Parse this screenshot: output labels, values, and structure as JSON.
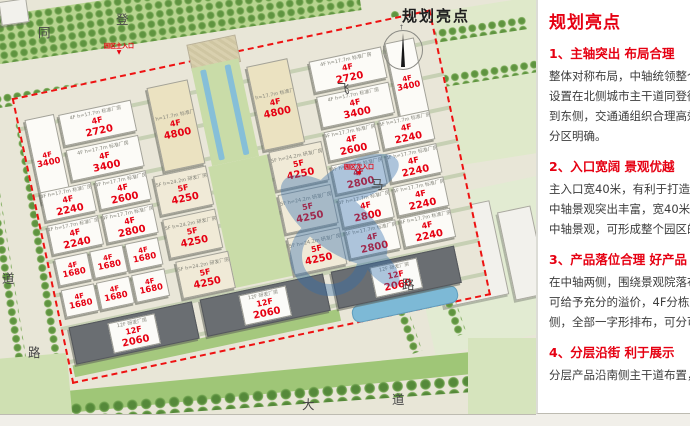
{
  "panel": {
    "title": "规划亮点",
    "accent_color": "#e60012",
    "sections": [
      {
        "heading": "1、主轴突出 布局合理",
        "lines": [
          "整体对称布局，中轴统领整个",
          "设置在北侧城市主干道同登街",
          "到东侧，交通通组织合理高效",
          "分区明确。"
        ]
      },
      {
        "heading": "2、入口宽阔 景观优越",
        "lines": [
          "主入口宽40米，有利于打造园",
          "中轴景观突出丰富，宽40米长",
          "中轴景观，可形成整个园区的"
        ]
      },
      {
        "heading": "3、产品落位合理 好产品",
        "lines": [
          "在中轴两侧，围绕景观院落布",
          "可给予充分的溢价，4F分栋产",
          "侧，全部一字形排布，可分可"
        ]
      },
      {
        "heading": "4、分层沿街 利于展示",
        "lines": [
          "分层产品沿南侧主干道布置，"
        ]
      }
    ]
  },
  "map": {
    "title": "规划亮点",
    "boundary_color": "#ee1212",
    "label_color": "#e60012",
    "road_labels": [
      {
        "t": "同",
        "x": 38,
        "y": 22
      },
      {
        "t": "登",
        "x": 116,
        "y": 9
      },
      {
        "t": "飞",
        "x": 337,
        "y": 78
      },
      {
        "t": "马",
        "x": 371,
        "y": 174
      },
      {
        "t": "路",
        "x": 402,
        "y": 274
      },
      {
        "t": "道",
        "x": 2,
        "y": 268
      },
      {
        "t": "路",
        "x": 28,
        "y": 342
      },
      {
        "t": "大",
        "x": 302,
        "y": 394
      },
      {
        "t": "道",
        "x": 392,
        "y": 389
      }
    ],
    "entrances": [
      {
        "label": "园区主入口",
        "x": 104,
        "y": 41,
        "arrow": true
      },
      {
        "label": "园区次入口",
        "x": 344,
        "y": 162,
        "arrow": true
      }
    ],
    "buildings": [
      {
        "x": 66,
        "y": 50,
        "w": 28,
        "h": 84,
        "f": "4F",
        "a": "3400",
        "cap": "4F h=17.7m 标准厂房",
        "t": "std"
      },
      {
        "x": 100,
        "y": 52,
        "w": 72,
        "h": 30,
        "f": "4F",
        "a": "2720",
        "cap": "4F h=17.7m 标准厂房",
        "t": "std"
      },
      {
        "x": 100,
        "y": 88,
        "w": 72,
        "h": 30,
        "f": "4F",
        "a": "3400",
        "cap": "4F h=17.7m 标准厂房",
        "t": "std"
      },
      {
        "x": 66,
        "y": 124,
        "w": 50,
        "h": 28,
        "f": "4F",
        "a": "2240",
        "cap": "4F h=17.7m 标准厂房",
        "t": "std"
      },
      {
        "x": 122,
        "y": 124,
        "w": 50,
        "h": 28,
        "f": "4F",
        "a": "2600",
        "cap": "4F h=17.7m 标准厂房",
        "t": "std"
      },
      {
        "x": 66,
        "y": 158,
        "w": 50,
        "h": 28,
        "f": "4F",
        "a": "2240",
        "cap": "4F h=17.7m 标准厂房",
        "t": "std"
      },
      {
        "x": 122,
        "y": 158,
        "w": 50,
        "h": 28,
        "f": "4F",
        "a": "2800",
        "cap": "4F h=17.7m 标准厂房",
        "t": "std"
      },
      {
        "x": 66,
        "y": 192,
        "w": 32,
        "h": 26,
        "f": "4F",
        "a": "1680",
        "cap": "",
        "t": "std"
      },
      {
        "x": 102,
        "y": 192,
        "w": 32,
        "h": 26,
        "f": "4F",
        "a": "1680",
        "cap": "",
        "t": "std"
      },
      {
        "x": 138,
        "y": 192,
        "w": 32,
        "h": 26,
        "f": "4F",
        "a": "1680",
        "cap": "",
        "t": "std"
      },
      {
        "x": 66,
        "y": 224,
        "w": 32,
        "h": 26,
        "f": "4F",
        "a": "1680",
        "cap": "",
        "t": "std"
      },
      {
        "x": 102,
        "y": 224,
        "w": 32,
        "h": 26,
        "f": "4F",
        "a": "1680",
        "cap": "",
        "t": "std"
      },
      {
        "x": 138,
        "y": 224,
        "w": 32,
        "h": 26,
        "f": "4F",
        "a": "1680",
        "cap": "",
        "t": "std"
      },
      {
        "x": 192,
        "y": 44,
        "w": 40,
        "h": 84,
        "f": "4F",
        "a": "4800",
        "cap": "4F h=17.7m 标准厂房",
        "t": "tall"
      },
      {
        "x": 294,
        "y": 44,
        "w": 40,
        "h": 84,
        "f": "4F",
        "a": "4800",
        "cap": "4F h=17.7m 标准厂房",
        "t": "tall"
      },
      {
        "x": 180,
        "y": 132,
        "w": 52,
        "h": 38,
        "f": "5F",
        "a": "4250",
        "cap": "5F h=24.2m 研发厂房",
        "t": "rnd"
      },
      {
        "x": 298,
        "y": 132,
        "w": 52,
        "h": 38,
        "f": "5F",
        "a": "4250",
        "cap": "5F h=24.2m 研发厂房",
        "t": "rnd"
      },
      {
        "x": 180,
        "y": 176,
        "w": 52,
        "h": 38,
        "f": "5F",
        "a": "4250",
        "cap": "5F h=24.2m 研发厂房",
        "t": "rnd"
      },
      {
        "x": 298,
        "y": 176,
        "w": 52,
        "h": 38,
        "f": "5F",
        "a": "4250",
        "cap": "5F h=24.2m 研发厂房",
        "t": "rnd"
      },
      {
        "x": 184,
        "y": 220,
        "w": 52,
        "h": 36,
        "f": "5F",
        "a": "4250",
        "cap": "5F h=24.2m 研发厂房",
        "t": "rnd"
      },
      {
        "x": 298,
        "y": 220,
        "w": 52,
        "h": 36,
        "f": "5F",
        "a": "4250",
        "cap": "5F h=24.2m 研发厂房",
        "t": "rnd"
      },
      {
        "x": 356,
        "y": 52,
        "w": 72,
        "h": 30,
        "f": "4F",
        "a": "2720",
        "cap": "4F h=17.7m 标准厂房",
        "t": "std"
      },
      {
        "x": 434,
        "y": 50,
        "w": 28,
        "h": 84,
        "f": "4F",
        "a": "3400",
        "cap": "4F h=17.7m 标准厂房",
        "t": "std"
      },
      {
        "x": 356,
        "y": 88,
        "w": 72,
        "h": 30,
        "f": "4F",
        "a": "3400",
        "cap": "4F h=17.7m 标准厂房",
        "t": "std"
      },
      {
        "x": 356,
        "y": 124,
        "w": 50,
        "h": 28,
        "f": "4F",
        "a": "2600",
        "cap": "4F h=17.7m 标准厂房",
        "t": "std"
      },
      {
        "x": 412,
        "y": 124,
        "w": 50,
        "h": 28,
        "f": "4F",
        "a": "2240",
        "cap": "4F h=17.7m 标准厂房",
        "t": "std"
      },
      {
        "x": 356,
        "y": 158,
        "w": 50,
        "h": 28,
        "f": "4F",
        "a": "2800",
        "cap": "4F h=17.7m 标准厂房",
        "t": "std"
      },
      {
        "x": 412,
        "y": 158,
        "w": 50,
        "h": 28,
        "f": "4F",
        "a": "2240",
        "cap": "4F h=17.7m 标准厂房",
        "t": "std"
      },
      {
        "x": 356,
        "y": 192,
        "w": 50,
        "h": 28,
        "f": "4F",
        "a": "2800",
        "cap": "4F h=17.7m 标准厂房",
        "t": "std"
      },
      {
        "x": 412,
        "y": 192,
        "w": 50,
        "h": 28,
        "f": "4F",
        "a": "2240",
        "cap": "4F h=17.7m 标准厂房",
        "t": "std"
      },
      {
        "x": 356,
        "y": 224,
        "w": 50,
        "h": 28,
        "f": "4F",
        "a": "2800",
        "cap": "4F h=17.7m 标准厂房",
        "t": "std"
      },
      {
        "x": 412,
        "y": 224,
        "w": 50,
        "h": 28,
        "f": "4F",
        "a": "2240",
        "cap": "4F h=17.7m 标准厂房",
        "t": "std"
      },
      {
        "x": 66,
        "y": 262,
        "w": 124,
        "h": 36,
        "f": "12F",
        "a": "2060",
        "cap": "12F 研发厂房",
        "t": "hi"
      },
      {
        "x": 200,
        "y": 262,
        "w": 124,
        "h": 36,
        "f": "12F",
        "a": "2060",
        "cap": "12F 研发厂房",
        "t": "hi"
      },
      {
        "x": 334,
        "y": 262,
        "w": 124,
        "h": 36,
        "f": "12F",
        "a": "2060",
        "cap": "12F 研发厂房",
        "t": "hi"
      }
    ]
  }
}
